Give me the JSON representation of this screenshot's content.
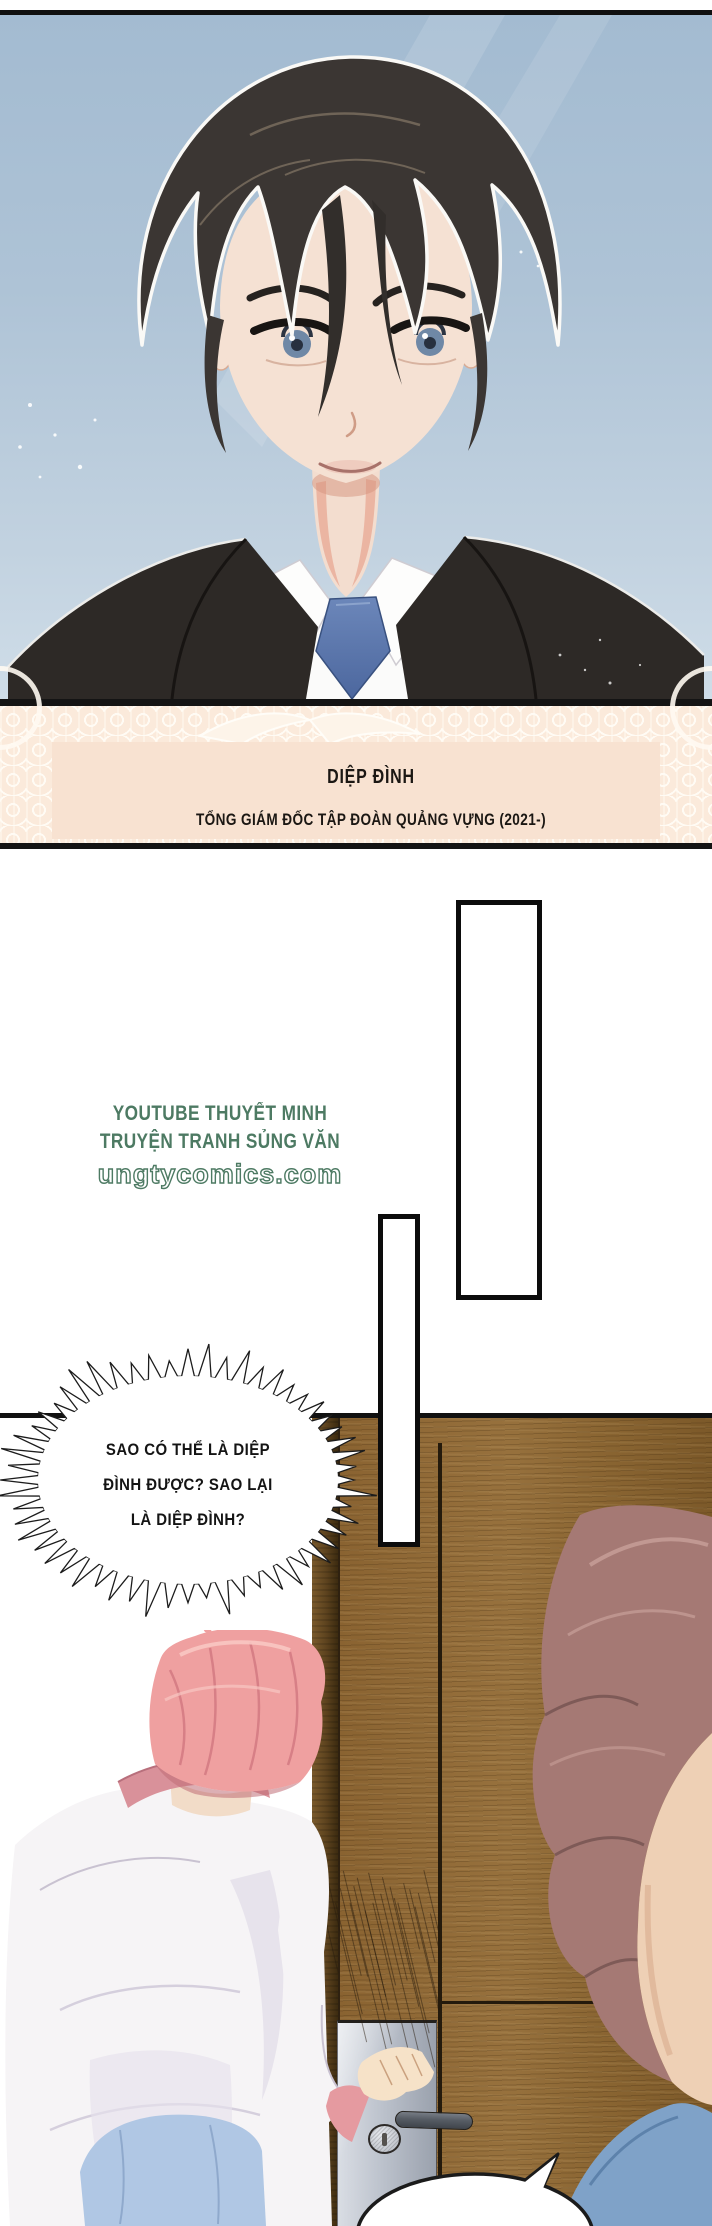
{
  "page": {
    "kind": "webtoon-comic-page",
    "width": 712,
    "height": 2226
  },
  "portrait_panel": {
    "description": "man with dark hair in black suit, white shirt and blue tie against blue sky",
    "sky_color": "#a3bbd1",
    "suit_color": "#2d2926",
    "tie_color": "#5d79ad",
    "hair_color": "#3b3633",
    "eye_color": "#6f88a6"
  },
  "caption_panel": {
    "character_name": "DIỆP ĐÌNH",
    "character_title": "TỔNG GIÁM ĐỐC TẬP ĐOÀN QUẢNG VỰNG (2021-)",
    "background_color": "#f8e2d1",
    "border_color": "#141414",
    "text_color": "#1b1713"
  },
  "watermark": {
    "line1": "YOUTUBE THUYẾT MINH",
    "line2": "TRUYỆN TRANH SỦNG VĂN",
    "line3": "ungtycomics.com",
    "color": "#4d7a63"
  },
  "burst_bubble": {
    "line1": "SAO CÓ THỂ LÀ DIỆP",
    "line2": "ĐÌNH ĐƯỢC? SAO LẠI",
    "line3": "LÀ DIỆP ĐÌNH?",
    "text_color": "#141414",
    "fill_color": "#ffffff",
    "outline_color": "#1c1c1c"
  },
  "scene_panel": {
    "description": "pink-haired person in white shirt opening wooden door, brown-haired person in blue seen from behind in foreground",
    "wall_color": "#e9dcc9",
    "door_wood_color": "#8a6331",
    "lock_plate_color": "#bcc2cc",
    "left_character_hair_color": "#efa0a0",
    "left_character_pants_color": "#b0c7e4",
    "right_character_hair_color": "#a57974",
    "right_character_clothes_color": "#7fa2c8"
  }
}
